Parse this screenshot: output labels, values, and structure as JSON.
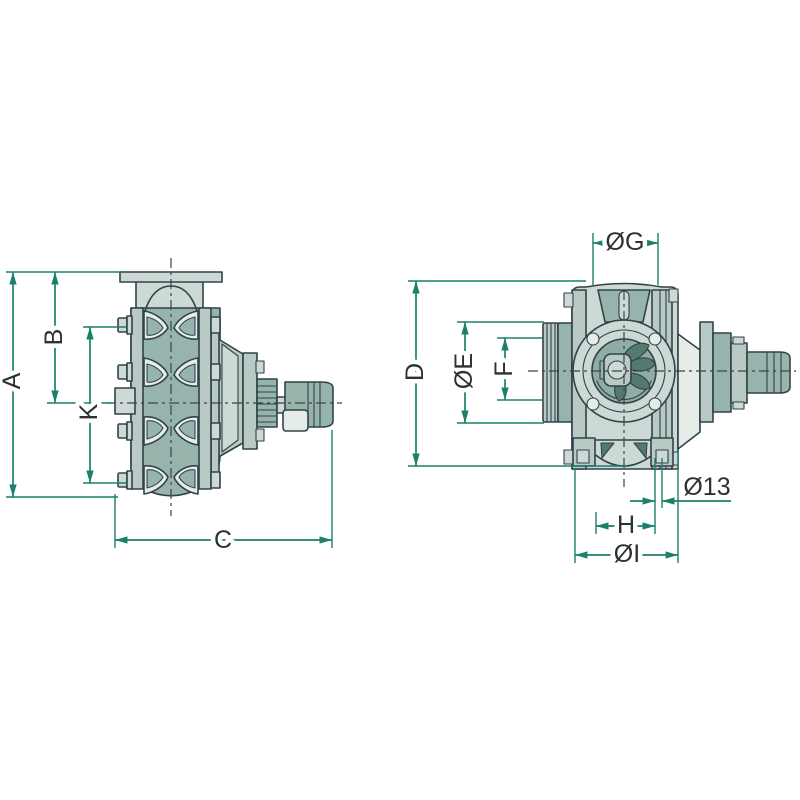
{
  "page": {
    "background": "#ffffff",
    "description": "Two-view technical dimension drawing of a centrifugal pump with hose coupling and PTO shaft stub"
  },
  "views": {
    "side": {
      "name": "side-view",
      "dimensions": [
        "A",
        "B",
        "K",
        "C"
      ]
    },
    "front": {
      "name": "front-view",
      "dimensions": [
        "D",
        "ØE",
        "F",
        "ØG",
        "Ø13",
        "H",
        "ØI"
      ]
    }
  },
  "dimensions": {
    "A": {
      "label": "A",
      "axis": "vertical"
    },
    "B": {
      "label": "B",
      "axis": "vertical"
    },
    "K": {
      "label": "K",
      "axis": "vertical"
    },
    "C": {
      "label": "C",
      "axis": "horizontal"
    },
    "D": {
      "label": "D",
      "axis": "vertical"
    },
    "E": {
      "label": "ØE",
      "axis": "vertical"
    },
    "F": {
      "label": "F",
      "axis": "vertical"
    },
    "G": {
      "label": "ØG",
      "axis": "horizontal"
    },
    "H": {
      "label": "H",
      "axis": "horizontal"
    },
    "I": {
      "label": "ØI",
      "axis": "horizontal"
    },
    "D13": {
      "label": "Ø13",
      "axis": "horizontal"
    }
  },
  "colors": {
    "bg": "#ffffff",
    "dim": "#1b8069",
    "ink": "#2c3133",
    "line": "#31424a",
    "cl": "#3a4448",
    "fill-light": "#cdd9d4",
    "fill-mid": "#97b4ac",
    "fill-soft": "#b9c9c3",
    "fill-pale": "#e6ede9",
    "fill-dark": "#54796d",
    "fill-inner": "#8fada4"
  }
}
